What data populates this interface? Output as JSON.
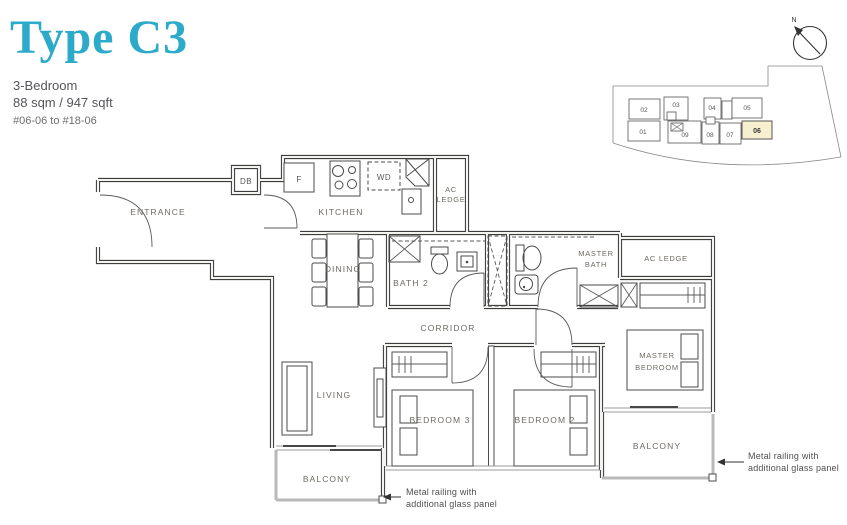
{
  "header": {
    "title": "Type C3",
    "type": "3-Bedroom",
    "area": "88 sqm / 947 sqft",
    "stack": "#06-06 to #18-06"
  },
  "compass": {
    "north_label": "N"
  },
  "keyplan": {
    "top_units": [
      "02",
      "03",
      "04",
      "05"
    ],
    "bottom_units": [
      "01",
      "09",
      "08",
      "07",
      "06"
    ],
    "highlighted_unit": "06",
    "highlight_color": "#f6f0d0"
  },
  "plan": {
    "labels": {
      "entrance": "ENTRANCE",
      "kitchen": "KITCHEN",
      "dining": "DINING",
      "bath2": "BATH 2",
      "master_bath": [
        "MASTER",
        "BATH"
      ],
      "ac_ledge_top": [
        "AC",
        "LEDGE"
      ],
      "ac_ledge_right": "AC LEDGE",
      "corridor": "CORRIDOR",
      "living": "LIVING",
      "bedroom3": "BEDROOM 3",
      "bedroom2": "BEDROOM 2",
      "master_bedroom": [
        "MASTER",
        "BEDROOM"
      ],
      "balcony_left": "BALCONY",
      "balcony_right": "BALCONY"
    },
    "fixtures": {
      "db": "DB",
      "fridge": "F",
      "washer_dryer": "WD"
    },
    "notes": {
      "railing_left": [
        "Metal railing with",
        "additional glass panel"
      ],
      "railing_right": [
        "Metal railing with",
        "additional glass panel"
      ]
    }
  },
  "colors": {
    "accent": "#2baac9",
    "label_gray": "#6e6a63",
    "wall": "#3d3d3d",
    "railing": "#b9b9b9"
  }
}
